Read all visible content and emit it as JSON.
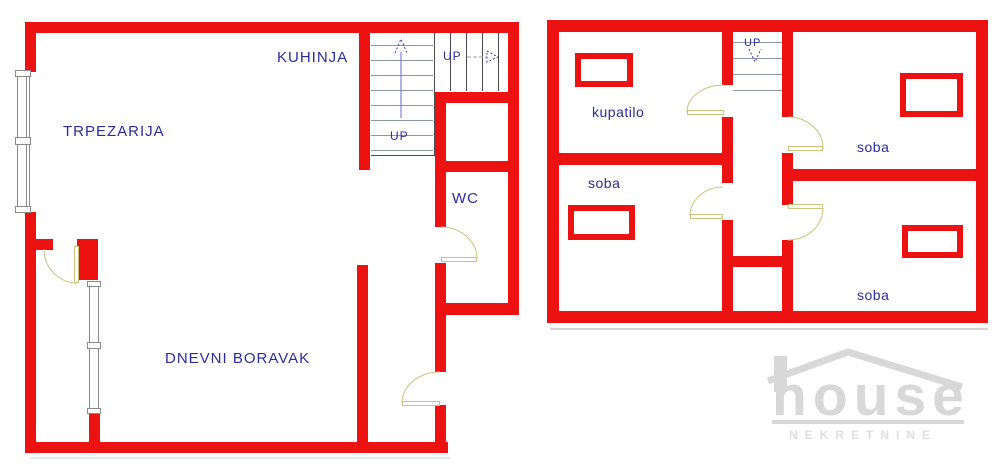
{
  "colors": {
    "wall": "#ed1212",
    "label": "#2b2b9e",
    "stair": "#8f95a6",
    "stairdark": "#4a4a4a",
    "door": "#c9c37d",
    "window": "#8a8a8a",
    "arrow": "#3a3ab8",
    "wm": "#d8d8d8",
    "shadow": "#d4d4d4"
  },
  "ground_floor": {
    "labels": {
      "dining": "TRPEZARIJA",
      "kitchen": "KUHINJA",
      "wc": "WC",
      "living": "DNEVNI BORAVAK",
      "stairs_up_lower": "UP",
      "stairs_up_upper": "UP"
    }
  },
  "upper_floor": {
    "labels": {
      "bathroom": "kupatilo",
      "room_left": "soba",
      "room_top_right": "soba",
      "room_bottom_right": "soba",
      "stairs_up": "UP"
    }
  },
  "watermark": {
    "brand": "house",
    "tagline": "NEKRETNINE"
  }
}
